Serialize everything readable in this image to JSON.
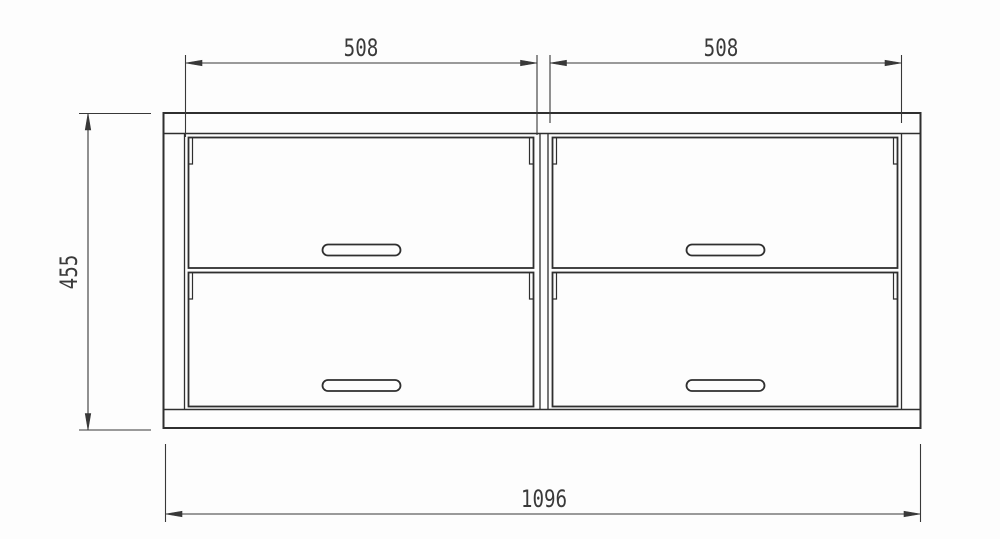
{
  "dimensions": {
    "drawer_width_left": "508",
    "drawer_width_right": "508",
    "overall_height": "455",
    "overall_width": "1096"
  },
  "colors": {
    "line": "#2f2f2f",
    "dimension": "#383838",
    "background": "#fdfdfd"
  }
}
